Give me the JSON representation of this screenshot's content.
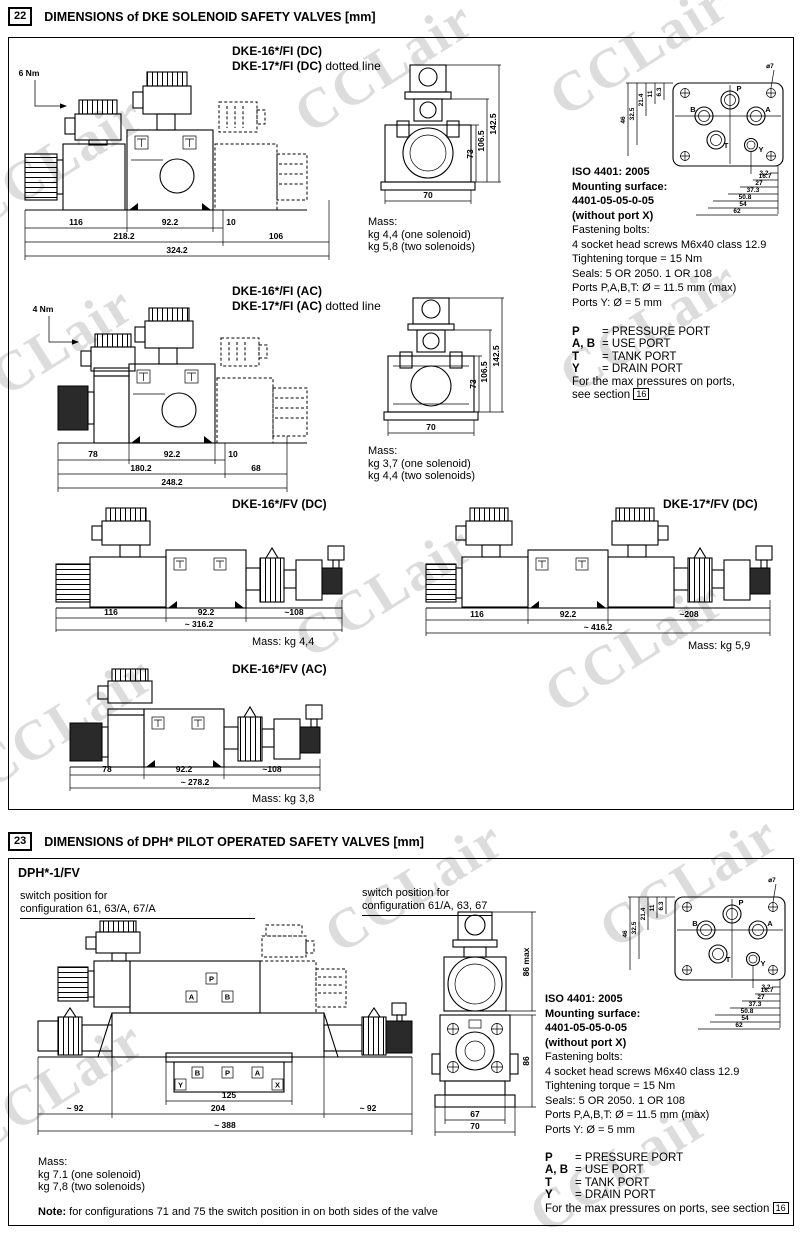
{
  "watermark": "CCLair",
  "sec22": {
    "num": "22",
    "title": "DIMENSIONS of DKE SOLENOID SAFETY VALVES [mm]",
    "fi_dc": {
      "line1": "DKE-16*/FI (DC)",
      "line2": "DKE-17*/FI (DC)",
      "line2_suffix": "dotted line",
      "torque": "6 Nm",
      "dims": [
        "116",
        "92.2",
        "10",
        "218.2",
        "106",
        "324.2"
      ]
    },
    "front_dc": {
      "dims": [
        "70",
        "73",
        "106.5",
        "142.5"
      ]
    },
    "mass_dc": {
      "label": "Mass:",
      "one": "kg 4,4 (one solenoid)",
      "two": "kg 5,8 (two solenoids)"
    },
    "fi_ac": {
      "line1": "DKE-16*/FI (AC)",
      "line2": "DKE-17*/FI (AC)",
      "line2_suffix": "dotted line",
      "torque": "4 Nm",
      "dims": [
        "78",
        "92.2",
        "10",
        "180.2",
        "68",
        "248.2"
      ]
    },
    "front_ac": {
      "dims": [
        "70",
        "73",
        "106.5",
        "142.5"
      ]
    },
    "mass_ac": {
      "label": "Mass:",
      "one": "kg 3,7 (one solenoid)",
      "two": "kg 4,4 (two solenoids)"
    },
    "fv_dc16": {
      "title": "DKE-16*/FV (DC)",
      "dims": [
        "116",
        "92.2",
        "~108",
        "~ 316.2"
      ],
      "mass": "Mass: kg 4,4"
    },
    "fv_dc17": {
      "title": "DKE-17*/FV (DC)",
      "dims": [
        "116",
        "92.2",
        "~208",
        "~ 416.2"
      ],
      "mass": "Mass: kg 5,9"
    },
    "fv_ac16": {
      "title": "DKE-16*/FV (AC)",
      "dims": [
        "78",
        "92.2",
        "~108",
        "~ 278.2"
      ],
      "mass": "Mass: kg 3,8"
    }
  },
  "iso": {
    "title": "ISO 4401: 2005",
    "line2": "Mounting surface:",
    "line3": "4401-05-05-0-05",
    "line4": "(without port X)",
    "line5": "Fastening bolts:",
    "line6": "4 socket head screws M6x40 class 12.9",
    "line7": "Tightening torque = 15 Nm",
    "line8": "Seals: 5 OR 2050. 1 OR 108",
    "line9": "Ports P,A,B,T: Ø = 11.5 mm (max)",
    "line10": "Ports Y: Ø = 5 mm",
    "dia": "⌀7",
    "ports": {
      "b": "B",
      "p": "P",
      "a": "A",
      "t": "T",
      "y": "Y"
    },
    "dims_left": [
      "46",
      "32.5",
      "21.4",
      "11",
      "6.3"
    ],
    "dims_bottom": [
      "3.2",
      "16.7",
      "27",
      "37.3",
      "50.8",
      "54",
      "62"
    ]
  },
  "legend": {
    "rows": [
      {
        "k": "P",
        "v": "= PRESSURE PORT"
      },
      {
        "k": "A, B",
        "v": "= USE PORT"
      },
      {
        "k": "T",
        "v": "= TANK PORT"
      },
      {
        "k": "Y",
        "v": "= DRAIN PORT"
      }
    ],
    "max1": "For the max pressures on ports,",
    "max2": "see section",
    "ref": "16",
    "max_inline": "For the max pressures on ports, see section"
  },
  "sec23": {
    "num": "23",
    "title": "DIMENSIONS of DPH* PILOT OPERATED SAFETY VALVES [mm]",
    "model": "DPH*-1/FV",
    "sw_left1": "switch position for",
    "sw_left2": "configuration 61, 63/A, 67/A",
    "sw_right1": "switch position for",
    "sw_right2": "configuration 61/A, 63, 67",
    "dims": [
      "~ 92",
      "125",
      "204",
      "~ 92",
      "~ 388"
    ],
    "pilot_ports": {
      "a": "A",
      "p": "P",
      "b": "B"
    },
    "manifold_ports": {
      "y": "Y",
      "b": "B",
      "p": "P",
      "a": "A",
      "x": "X"
    },
    "front_dims": [
      "86 max",
      "86",
      "67",
      "70"
    ],
    "mass": {
      "label": "Mass:",
      "one": "kg 7.1 (one solenoid)",
      "two": "kg 7,8 (two solenoids)"
    },
    "note_label": "Note:",
    "note_text": " for configurations 71 and 75 the switch position in on both sides of the valve"
  }
}
